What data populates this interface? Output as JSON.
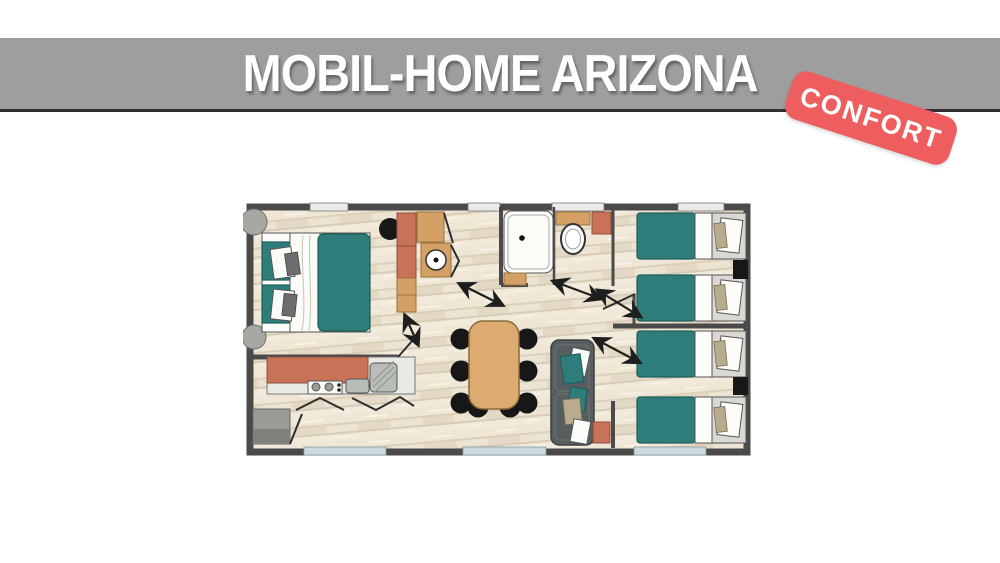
{
  "header": {
    "title": "MOBIL-HOME ARIZONA"
  },
  "badge": {
    "label": "CONFORT"
  },
  "colors": {
    "page_bg": "#ffffff",
    "header_bar": "#9e9e9e",
    "header_border": "#303030",
    "header_text": "#ffffff",
    "badge_bg": "#ee5e5e",
    "badge_text": "#ffffff",
    "wall": "#4a4a4a",
    "floor_base": "#e9dfcd",
    "teal": "#2f7d7a",
    "terracotta": "#c87257",
    "wood": "#d4a066",
    "sofa_gray": "#585d5f",
    "frame_gray": "#d9d8d3",
    "window_glass": "#ccdadd",
    "black_furniture": "#171717"
  }
}
